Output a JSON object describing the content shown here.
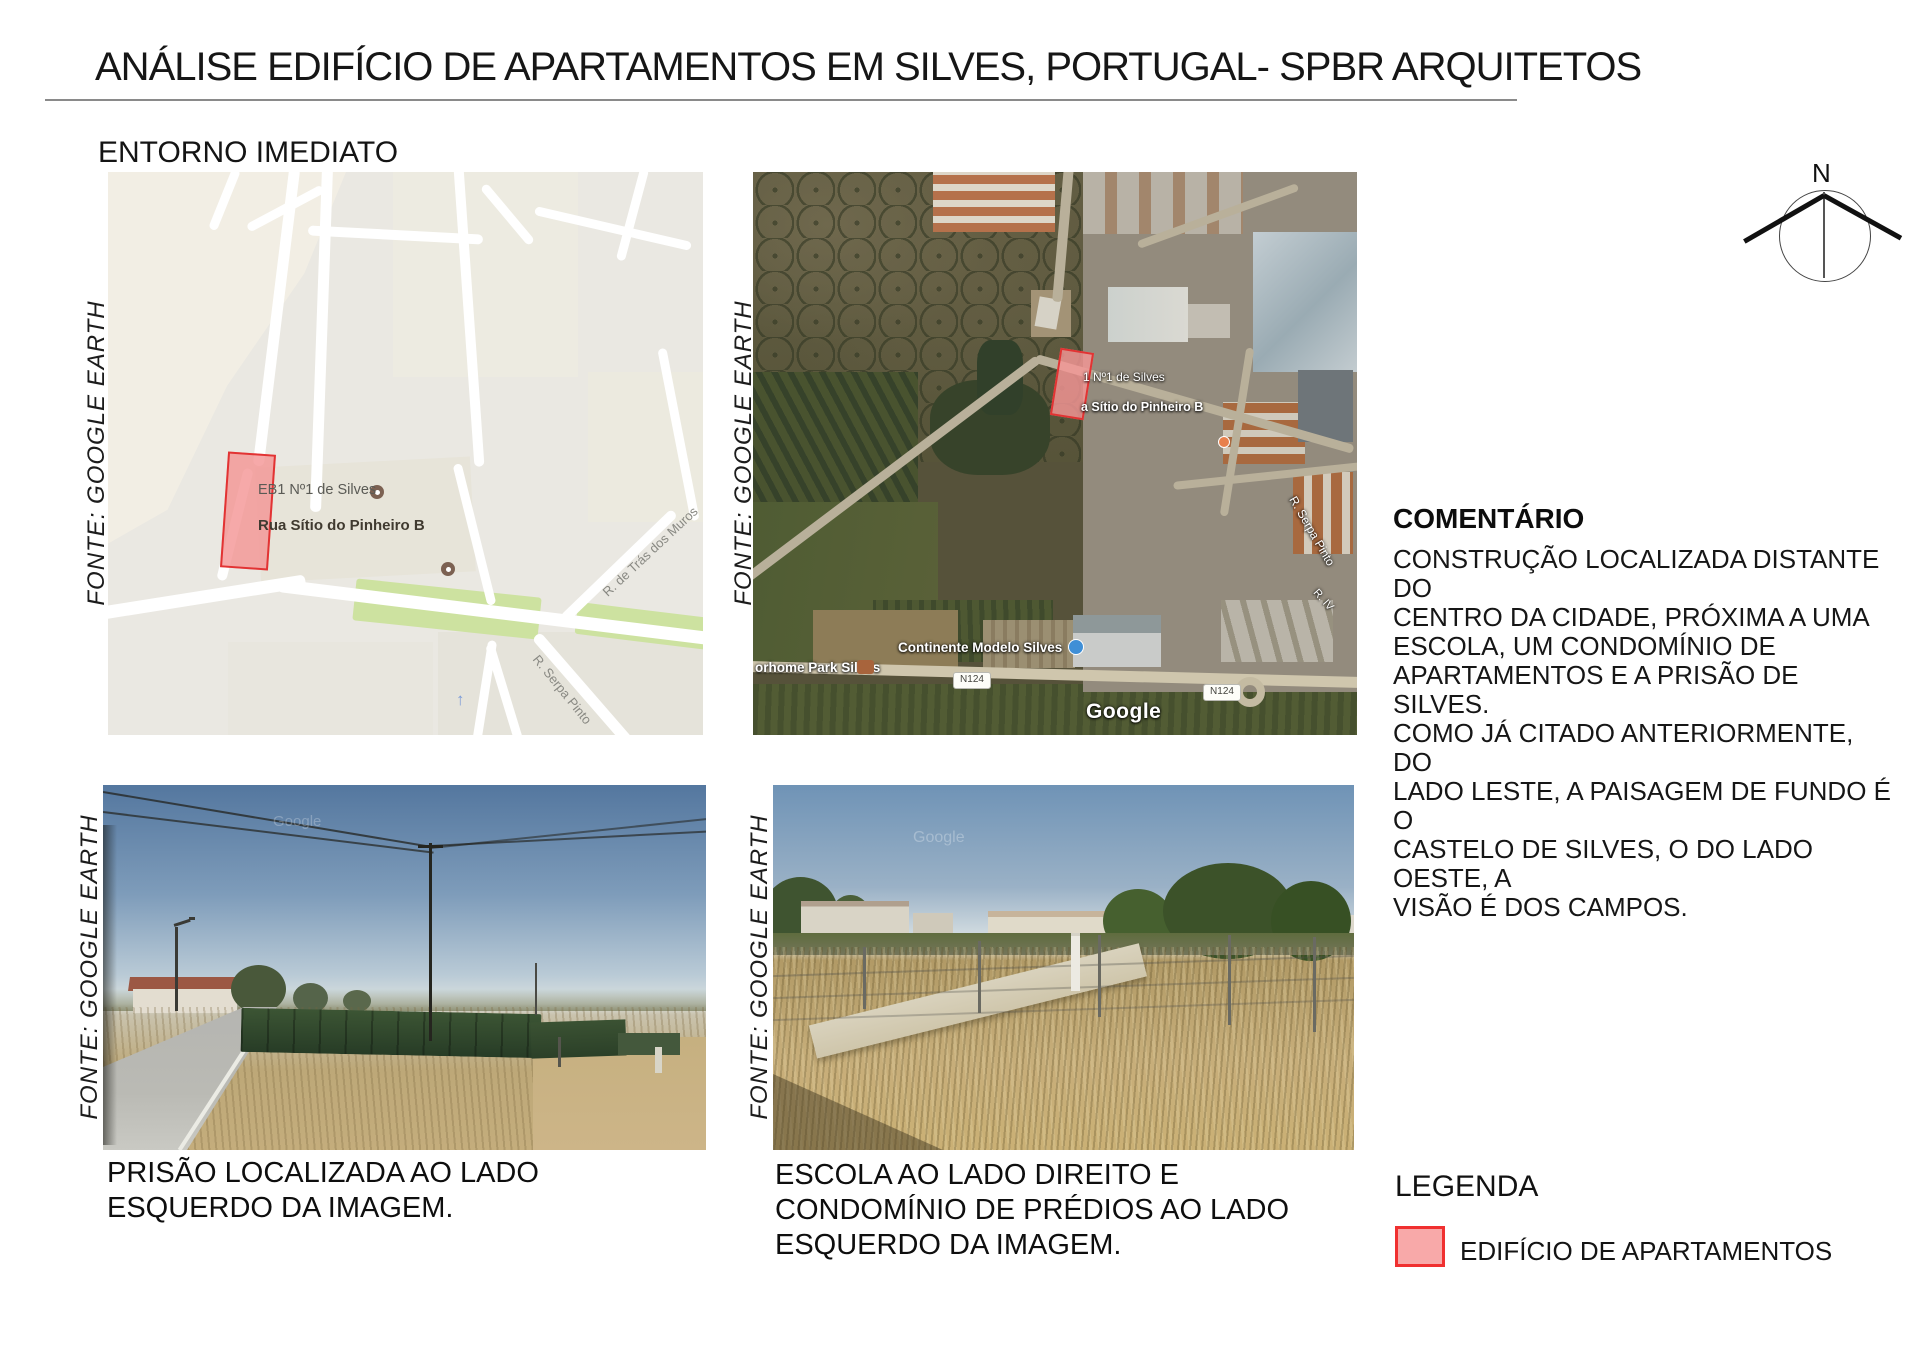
{
  "header": {
    "title": "ANÁLISE EDIFÍCIO DE APARTAMENTOS EM SILVES, PORTUGAL- SPBR ARQUITETOS",
    "section": "ENTORNO IMEDIATO"
  },
  "source_label": "FONTE: GOOGLE EARTH",
  "compass": {
    "north": "N"
  },
  "street_map": {
    "school": "EB1 Nº1 de Silves",
    "street_main": "Rua Sítio do Pinheiro B",
    "street_tras": "R. de Trás dos Muros",
    "street_serpa": "R. Serpa Pinto"
  },
  "satellite": {
    "school": "1 Nº1 de Silves",
    "street_sitio": "a Sítio do Pinheiro B",
    "street_serpa": "R. Serpa Pinto",
    "street_riv": "R. IV",
    "supermarket": "Continente Modelo Silves",
    "motorhome": "orhome Park Silves",
    "shield1": "N124",
    "shield2": "N124",
    "watermark": "Google"
  },
  "photos": {
    "left": {
      "watermark": "Google",
      "caption": [
        "PRISÃO LOCALIZADA AO LADO",
        "ESQUERDO DA IMAGEM."
      ]
    },
    "right": {
      "watermark": "Google",
      "caption": [
        "ESCOLA AO LADO DIREITO E",
        "CONDOMÍNIO DE PRÉDIOS AO LADO",
        "ESQUERDO DA IMAGEM."
      ]
    }
  },
  "comment": {
    "heading": "COMENTÁRIO",
    "body": [
      "CONSTRUÇÃO LOCALIZADA DISTANTE DO",
      "CENTRO DA CIDADE, PRÓXIMA A UMA",
      "ESCOLA, UM CONDOMÍNIO DE",
      "APARTAMENTOS E A PRISÃO DE SILVES.",
      "COMO JÁ CITADO ANTERIORMENTE, DO",
      "LADO LESTE, A PAISAGEM DE FUNDO É O",
      "CASTELO DE SILVES, O DO LADO OESTE, A",
      "VISÃO É DOS CAMPOS."
    ]
  },
  "legend": {
    "heading": "LEGENDA",
    "items": [
      {
        "label": "EDIFÍCIO DE APARTAMENTOS",
        "fill": "#f8a9a9",
        "border": "#f03030"
      }
    ]
  },
  "colors": {
    "parcel_fill": "#f5a0a0",
    "parcel_border": "#e23333",
    "map_green": "#cde2a0",
    "rule_gray": "#8a8a8a"
  }
}
